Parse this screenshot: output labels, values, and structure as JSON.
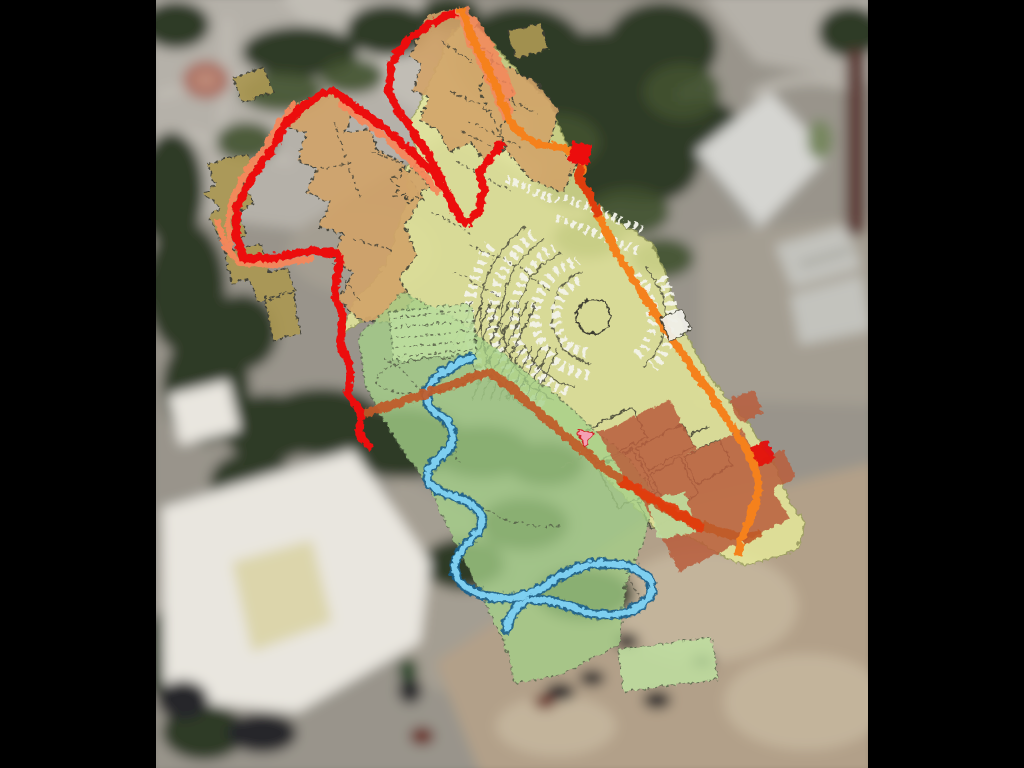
{
  "canvas": {
    "width": 1024,
    "height": 768,
    "letterbox_color": "#000000"
  },
  "map": {
    "kind": "aerial-photo-with-site-plan-overlay",
    "has_text": false,
    "legend": [
      {
        "feature": "site-boundary",
        "color_key": "boundary_red"
      },
      {
        "feature": "boundary-inner-lining",
        "color_key": "boundary_salmon"
      },
      {
        "feature": "main-route",
        "color_key": "road_orange"
      },
      {
        "feature": "secondary-route",
        "color_key": "road_dark_orange"
      },
      {
        "feature": "route-highlight",
        "color_key": "road_orange_red"
      },
      {
        "feature": "planned-buildings",
        "color_key": "building_tan"
      },
      {
        "feature": "annex-buildings",
        "color_key": "building_khaki"
      },
      {
        "feature": "development-zone",
        "color_key": "zone_yellow"
      },
      {
        "feature": "green-space",
        "color_key": "zone_green"
      },
      {
        "feature": "special-use-zone",
        "color_key": "zone_terracotta"
      },
      {
        "feature": "stream",
        "color_key": "stream_fill"
      },
      {
        "feature": "parking-stalls",
        "color_key": "stall_white"
      },
      {
        "feature": "marker",
        "color_key": "marker_pink"
      }
    ]
  },
  "colors": {
    "letterbox": "#000000",
    "sat_base": "#99948b",
    "sat_pavement": "#b5b1a9",
    "sat_pavement_dark": "#a49e92",
    "sat_path_light": "#c1bdb5",
    "sat_tree_dark": "#2e3b25",
    "sat_tree_mid": "#41522f",
    "sat_building_white": "#e9e6df",
    "sat_building_cream": "#dcd5ab",
    "sat_building_gray": "#d5d5d1",
    "sat_container_gray": "#c3c3bd",
    "sat_ground_tan": "#b2a089",
    "sat_ground_tan_light": "#c3b49b",
    "sat_maroon": "#5f3c37",
    "sat_flowerbed": "#a96b5d",
    "sat_flowerbed_light": "#bd8a78",
    "sat_car_dark": "#26262c",
    "sat_car_red": "#6a2a24",
    "sat_car_green": "#2c4a2c",
    "sat_shadow": "#6f6f68",
    "zone_yellow": "#e9ed9a",
    "zone_yellow_edge": "#9aa05a",
    "zone_green": "#a5d088",
    "zone_green_edge": "#55684a",
    "zone_green_light": "#bfe0a0",
    "zone_terracotta": "#b95e3c",
    "bright_red_patch": "#e41008",
    "building_tan": "#d2a469",
    "building_khaki": "#ab9752",
    "plan_line": "#3e3e33",
    "stall_white": "#f3f3ea",
    "boundary_red": "#ec1111",
    "boundary_salmon": "#f6875b",
    "road_orange": "#f5811f",
    "road_orange_red": "#e03c10",
    "road_dark_orange": "#c05a28",
    "stream_bank": "#2a4a5a",
    "stream_edge": "#19618f",
    "stream_fill": "#7ecff0",
    "marker_pink": "#f5a0b4",
    "marker_pink_stroke": "#d02020",
    "white_patch": "#f0efe8"
  }
}
